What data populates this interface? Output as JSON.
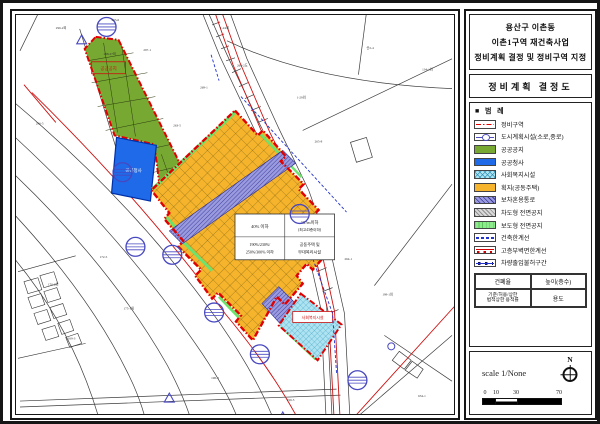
{
  "title_block": {
    "line1": "용산구 이촌동",
    "line2": "이촌1구역 재건축사업",
    "line3": "정비계획 결정 및 정비구역 지정"
  },
  "subtitle_block": {
    "title": "정비계획 결정도"
  },
  "legend": {
    "header_square": "■",
    "header": "범  례",
    "items": [
      {
        "label": "정비구역"
      },
      {
        "label": "도시계획시설(소로,중로)"
      },
      {
        "label": "공공공지"
      },
      {
        "label": "공공청사"
      },
      {
        "label": "사회복지시설"
      },
      {
        "label": "획지(공동주택)"
      },
      {
        "label": "보차혼용통로"
      },
      {
        "label": "차도형 전면공지"
      },
      {
        "label": "보도형 전면공지"
      },
      {
        "label": "건축한계선"
      },
      {
        "label": "고층부벽면한계선"
      },
      {
        "label": "차량출입불허구간"
      }
    ],
    "table": {
      "r1c1": "건폐율",
      "r1c2": "높이(층수)",
      "r2c1a": "기준/허용/상한",
      "r2c1b": "법적상한 용적률",
      "r2c2": "용도"
    }
  },
  "scale_block": {
    "scale_text": "scale 1/None",
    "north_label": "N",
    "ticks": [
      "0",
      "10",
      "30",
      "70"
    ]
  },
  "map": {
    "zone_table": {
      "coverage": "40% 이하",
      "height1": "167m이하",
      "height2": "(최고43층이하)",
      "far1": "190%/230%/",
      "far2": "250%/300% 이하",
      "use1": "공동주택 및",
      "use2": "부대복리시설"
    },
    "area_labels": {
      "green": "공공공지",
      "blue": "공공청사",
      "cyan": "사회복지시설"
    },
    "lot_labels": [
      {
        "text": "296-2외"
      },
      {
        "text": "295-6"
      },
      {
        "text": "297-1"
      },
      {
        "text": "1-24외"
      },
      {
        "text": "268-2도"
      },
      {
        "text": "269-1"
      },
      {
        "text": "263-5"
      },
      {
        "text": "1-29외"
      },
      {
        "text": "산2-4"
      },
      {
        "text": "134-1외"
      },
      {
        "text": "265-8"
      },
      {
        "text": "264-1"
      },
      {
        "text": "199-1외"
      },
      {
        "text": "172-5"
      },
      {
        "text": "170-2외"
      },
      {
        "text": "175-1외"
      },
      {
        "text": "169-3"
      },
      {
        "text": "198-4"
      },
      {
        "text": "199-5"
      },
      {
        "text": "634-1"
      },
      {
        "text": "298-27외"
      },
      {
        "text": "296-5"
      }
    ],
    "colors": {
      "boundary_red": "#e00000",
      "public_open_space_green": "#76a832",
      "public_office_blue": "#1f6ae8",
      "welfare_cyan": "#aee4f2",
      "housing_orange": "#f6b42c",
      "mixed_passage_purple": "#9a9ade",
      "sidewalk_front_green": "#8dea8d",
      "road_symbol_purple": "#4848c0",
      "limit_line_blue": "#2233cc"
    }
  }
}
